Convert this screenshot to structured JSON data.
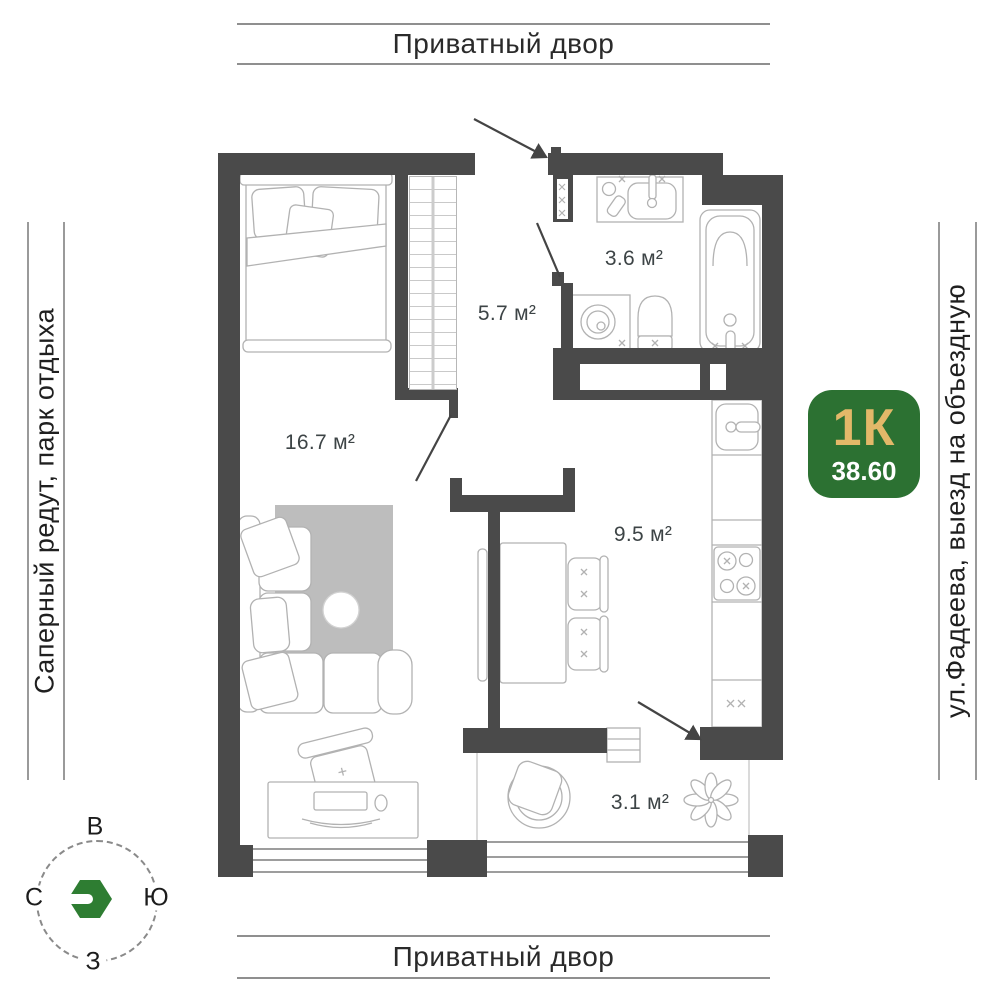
{
  "surroundings": {
    "top_label": "Приватный двор",
    "bottom_label": "Приватный двор",
    "left_label": "Саперный редут, парк отдыха",
    "right_label": "ул.Фадеева, выезд на объездную"
  },
  "unit_badge": {
    "type_label": "1К",
    "area_value": "38.60",
    "bg_color": "#2c7132",
    "type_color": "#e3b869",
    "area_color": "#ffffff"
  },
  "compass": {
    "top": "В",
    "right": "Ю",
    "bottom": "З",
    "left": "С",
    "logo_color": "#2e7d32"
  },
  "rooms": {
    "bathroom": {
      "area": "3.6 м²"
    },
    "hallway": {
      "area": "5.7 м²"
    },
    "living_room": {
      "area": "16.7 м²"
    },
    "kitchen": {
      "area": "9.5 м²"
    },
    "balcony": {
      "area": "3.1 м²"
    }
  },
  "colors": {
    "wall": "#4a4a4a",
    "furniture_line": "#b2b2b2",
    "rug": "#bdbdbd",
    "label_text": "#3d4446"
  }
}
